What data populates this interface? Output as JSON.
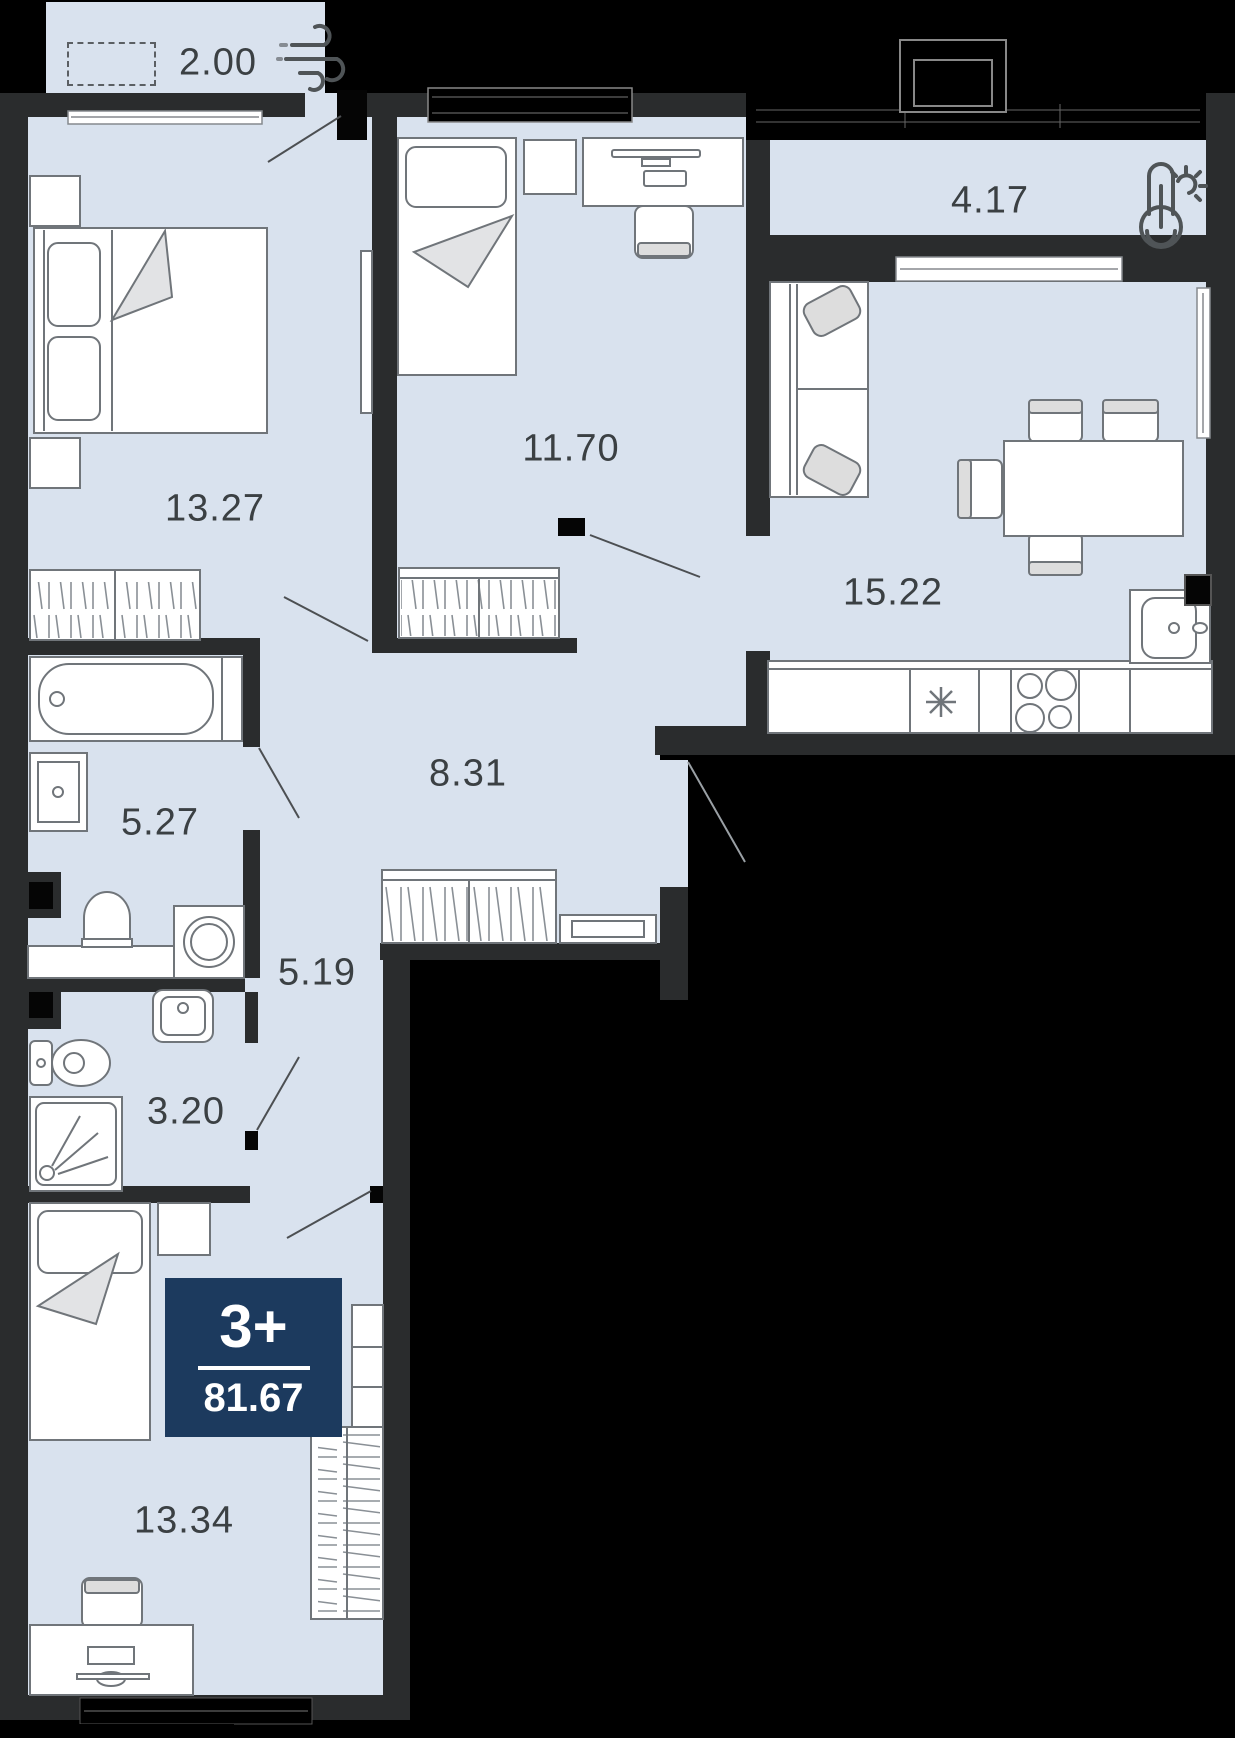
{
  "plan": {
    "badge": {
      "type_label": "3+",
      "total_area": "81.67"
    },
    "rooms": {
      "balcony": {
        "area": "2.00"
      },
      "bedroom_master": {
        "area": "13.27"
      },
      "bedroom_child": {
        "area": "11.70"
      },
      "loggia": {
        "area": "4.17"
      },
      "kitchen_living": {
        "area": "15.22"
      },
      "hallway": {
        "area": "8.31"
      },
      "bathroom": {
        "area": "5.27"
      },
      "corridor": {
        "area": "5.19"
      },
      "wc": {
        "area": "3.20"
      },
      "bedroom_third": {
        "area": "13.34"
      }
    },
    "icons": {
      "wind": "wind-icon",
      "thermometer": "thermometer-sun-icon"
    },
    "colors": {
      "floor": "#d9e2ee",
      "wall": "#2a2c2d",
      "badge": "#1c3a5e",
      "background": "#000000",
      "furniture_line": "#70757a"
    }
  }
}
